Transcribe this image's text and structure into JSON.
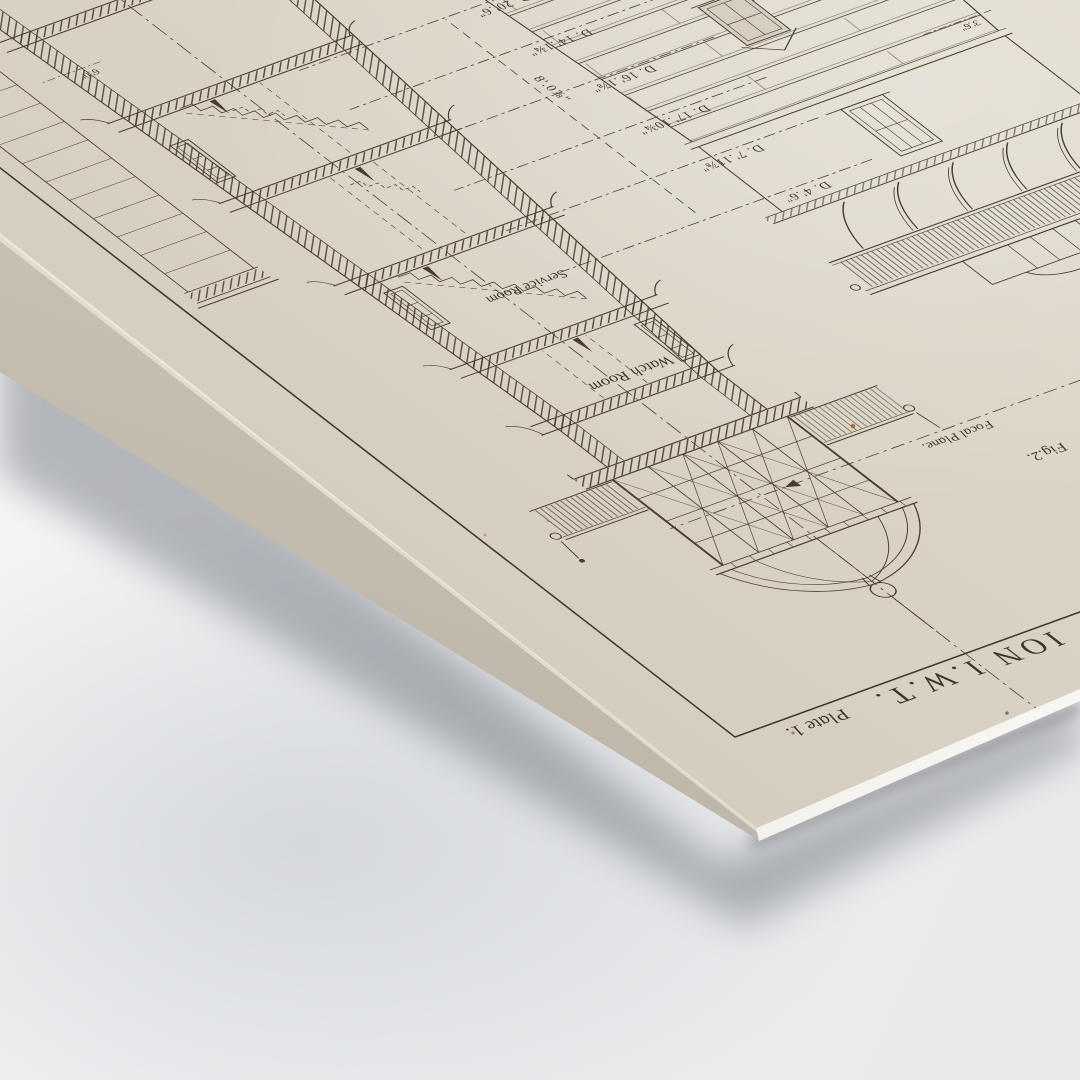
{
  "meta": {
    "description": "Photograph of a vintage printed architectural plate (lighthouse sectional elevation) lying rotated on a light surface",
    "background_color": "#eef0f2",
    "paper_color": "#d8d1c3",
    "ink_color": "#3e352a"
  },
  "plate": {
    "title_fragment": "ION I.W.T.",
    "plate_label": "Plate 1.",
    "figure2_label": "Fig.2.",
    "annotations": {
      "focal_plane": "Focal Plane.",
      "watch_room": "Watch Room",
      "service_room": "Service Room"
    },
    "levels": [
      "D. 4'.6\"",
      "D. 7'.11⅞\"",
      "D. 17'.10¾\"",
      "D. 16'.1⅞\"",
      "D. 14'.1¾\"",
      "D. 20'.6\""
    ],
    "height_dim": "8'.0⅞\"",
    "course_dims": [
      "3'.6\"",
      "3'.6\""
    ],
    "base_dim": "6'.0\""
  }
}
